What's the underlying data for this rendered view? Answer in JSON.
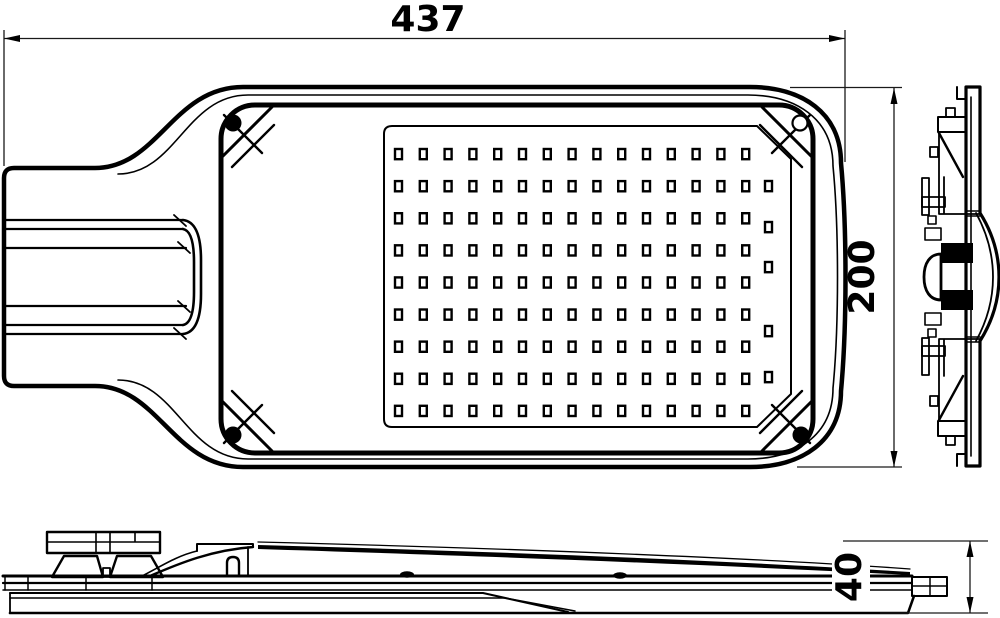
{
  "page": {
    "background": "#ffffff",
    "ink": "#000000",
    "dim_color": "#1a1a1a"
  },
  "drawing": {
    "type": "technical-orthographic-drawing",
    "subject": "LED street light luminaire",
    "views": [
      {
        "id": "plan-view",
        "label": "top plan view with LED array"
      },
      {
        "id": "end-profile-view",
        "label": "right end profile view"
      },
      {
        "id": "side-elevation-view",
        "label": "bottom side elevation view"
      }
    ],
    "dimensions": {
      "width": {
        "value": "437",
        "orientation": "horizontal"
      },
      "height": {
        "value": "200",
        "orientation": "vertical"
      },
      "thickness": {
        "value": "40",
        "orientation": "vertical"
      }
    },
    "led_grid": {
      "rows": 9,
      "cols": 15,
      "x0": 395,
      "y0": 149,
      "dx": 24.8,
      "dy": 32.1,
      "led_w": 7,
      "led_h": 10.2,
      "stroke": 2.4,
      "extra_col_x": 765,
      "extra_col_y": [
        181,
        222,
        262,
        326,
        372
      ]
    }
  }
}
